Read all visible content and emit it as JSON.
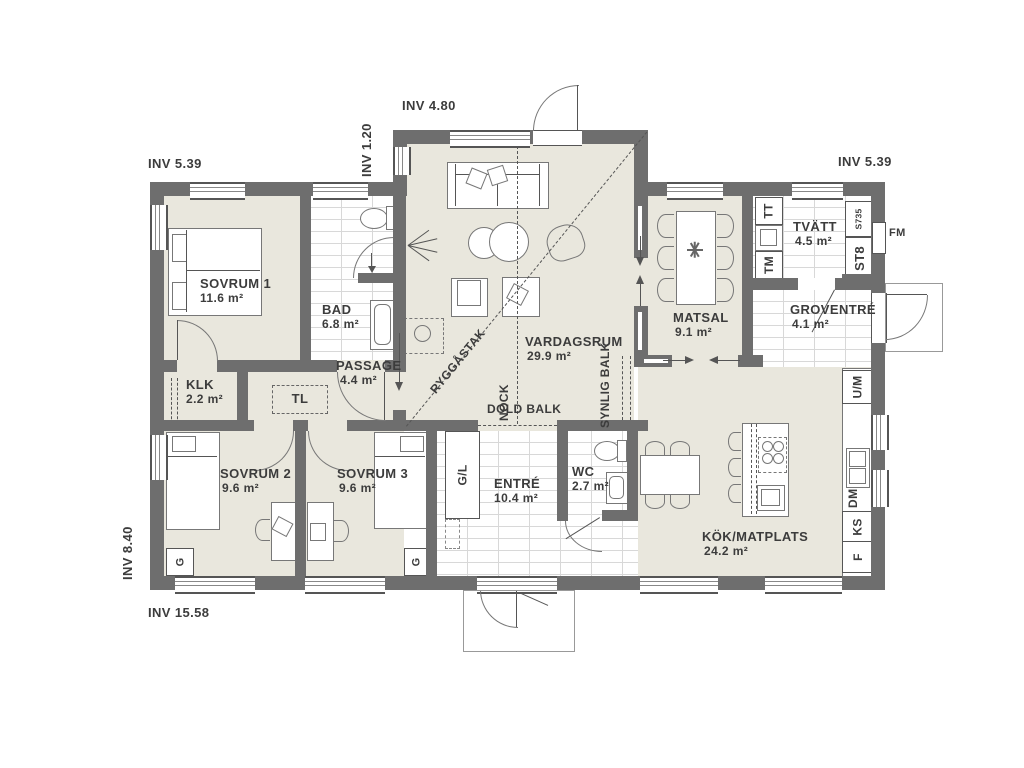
{
  "colors": {
    "wall": "#6e6e6e",
    "floor": "#e9e7dd"
  },
  "dimensions": {
    "top_left": "INV 5.39",
    "top_center": "INV 4.80",
    "top_step": "INV 1.20",
    "top_right": "INV 5.39",
    "left": "INV 8.40",
    "bottom": "INV 15.58"
  },
  "rooms": {
    "sovrum1": {
      "name": "SOVRUM 1",
      "area": "11.6 m²"
    },
    "bad": {
      "name": "BAD",
      "area": "6.8 m²"
    },
    "klk": {
      "name": "KLK",
      "area": "2.2 m²"
    },
    "passage": {
      "name": "PASSAGE",
      "area": "4.4 m²"
    },
    "sovrum2": {
      "name": "SOVRUM 2",
      "area": "9.6 m²"
    },
    "sovrum3": {
      "name": "SOVRUM 3",
      "area": "9.6 m²"
    },
    "vardagsrum": {
      "name": "VARDAGSRUM",
      "area": "29.9 m²"
    },
    "entre": {
      "name": "ENTRÉ",
      "area": "10.4 m²"
    },
    "wc": {
      "name": "WC",
      "area": "2.7 m²"
    },
    "matsal": {
      "name": "MATSAL",
      "area": "9.1 m²"
    },
    "tvatt": {
      "name": "TVÄTT",
      "area": "4.5 m²"
    },
    "groventre": {
      "name": "GROVENTRÉ",
      "area": "4.1 m²"
    },
    "kok": {
      "name": "KÖK/MATPLATS",
      "area": "24.2 m²"
    }
  },
  "fixtures": {
    "tl": "TL",
    "gl": "G/L",
    "g1": "G",
    "g2": "G",
    "tt": "TT",
    "tm": "TM",
    "st8": "ST8",
    "s735": "S735",
    "fm": "FM",
    "um": "U/M",
    "dm": "DM",
    "ks": "KS",
    "f": "F"
  },
  "beams": {
    "ryggastak": "RYGGÅSTAK",
    "nock": "NOCK",
    "dold_balk": "DOLD BALK",
    "synlig_balk": "SYNLIG BALK"
  }
}
